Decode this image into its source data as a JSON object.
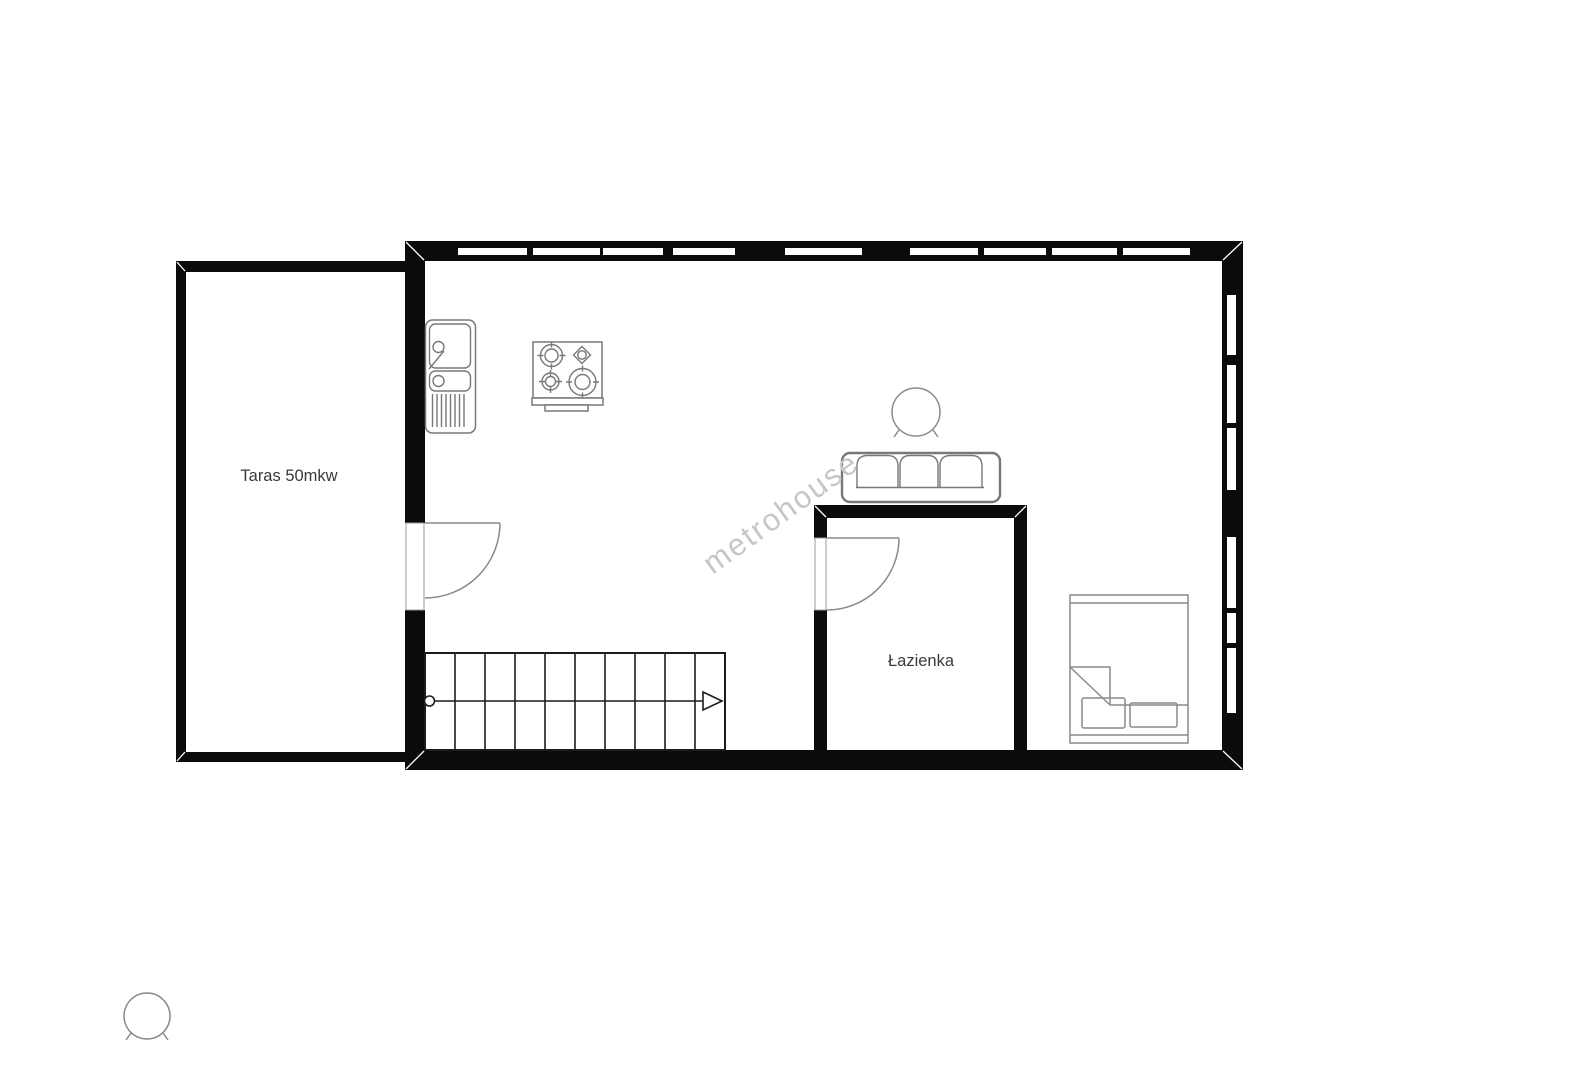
{
  "page": {
    "width": 1581,
    "height": 1080,
    "background": "#ffffff"
  },
  "floorplan": {
    "watermark": "metrohouse",
    "rooms": [
      {
        "id": "terrace",
        "label": "Taras 50mkw"
      },
      {
        "id": "bathroom",
        "label": "Łazienka"
      }
    ],
    "colors": {
      "wall": "#0b0b0b",
      "furniture_stroke": "#787878",
      "stairs_stroke": "#1c1c1c",
      "label_text": "#3a3a3a",
      "watermark_text": "#c6c6c6",
      "background": "#ffffff"
    },
    "furniture_icons": [
      "kitchen-sink-icon",
      "stove-icon",
      "sofa-icon",
      "round-table-icon",
      "bed-icon",
      "stairs-icon",
      "entry-door-swing-icon",
      "bathroom-door-swing-icon",
      "detached-round-table-icon"
    ]
  }
}
